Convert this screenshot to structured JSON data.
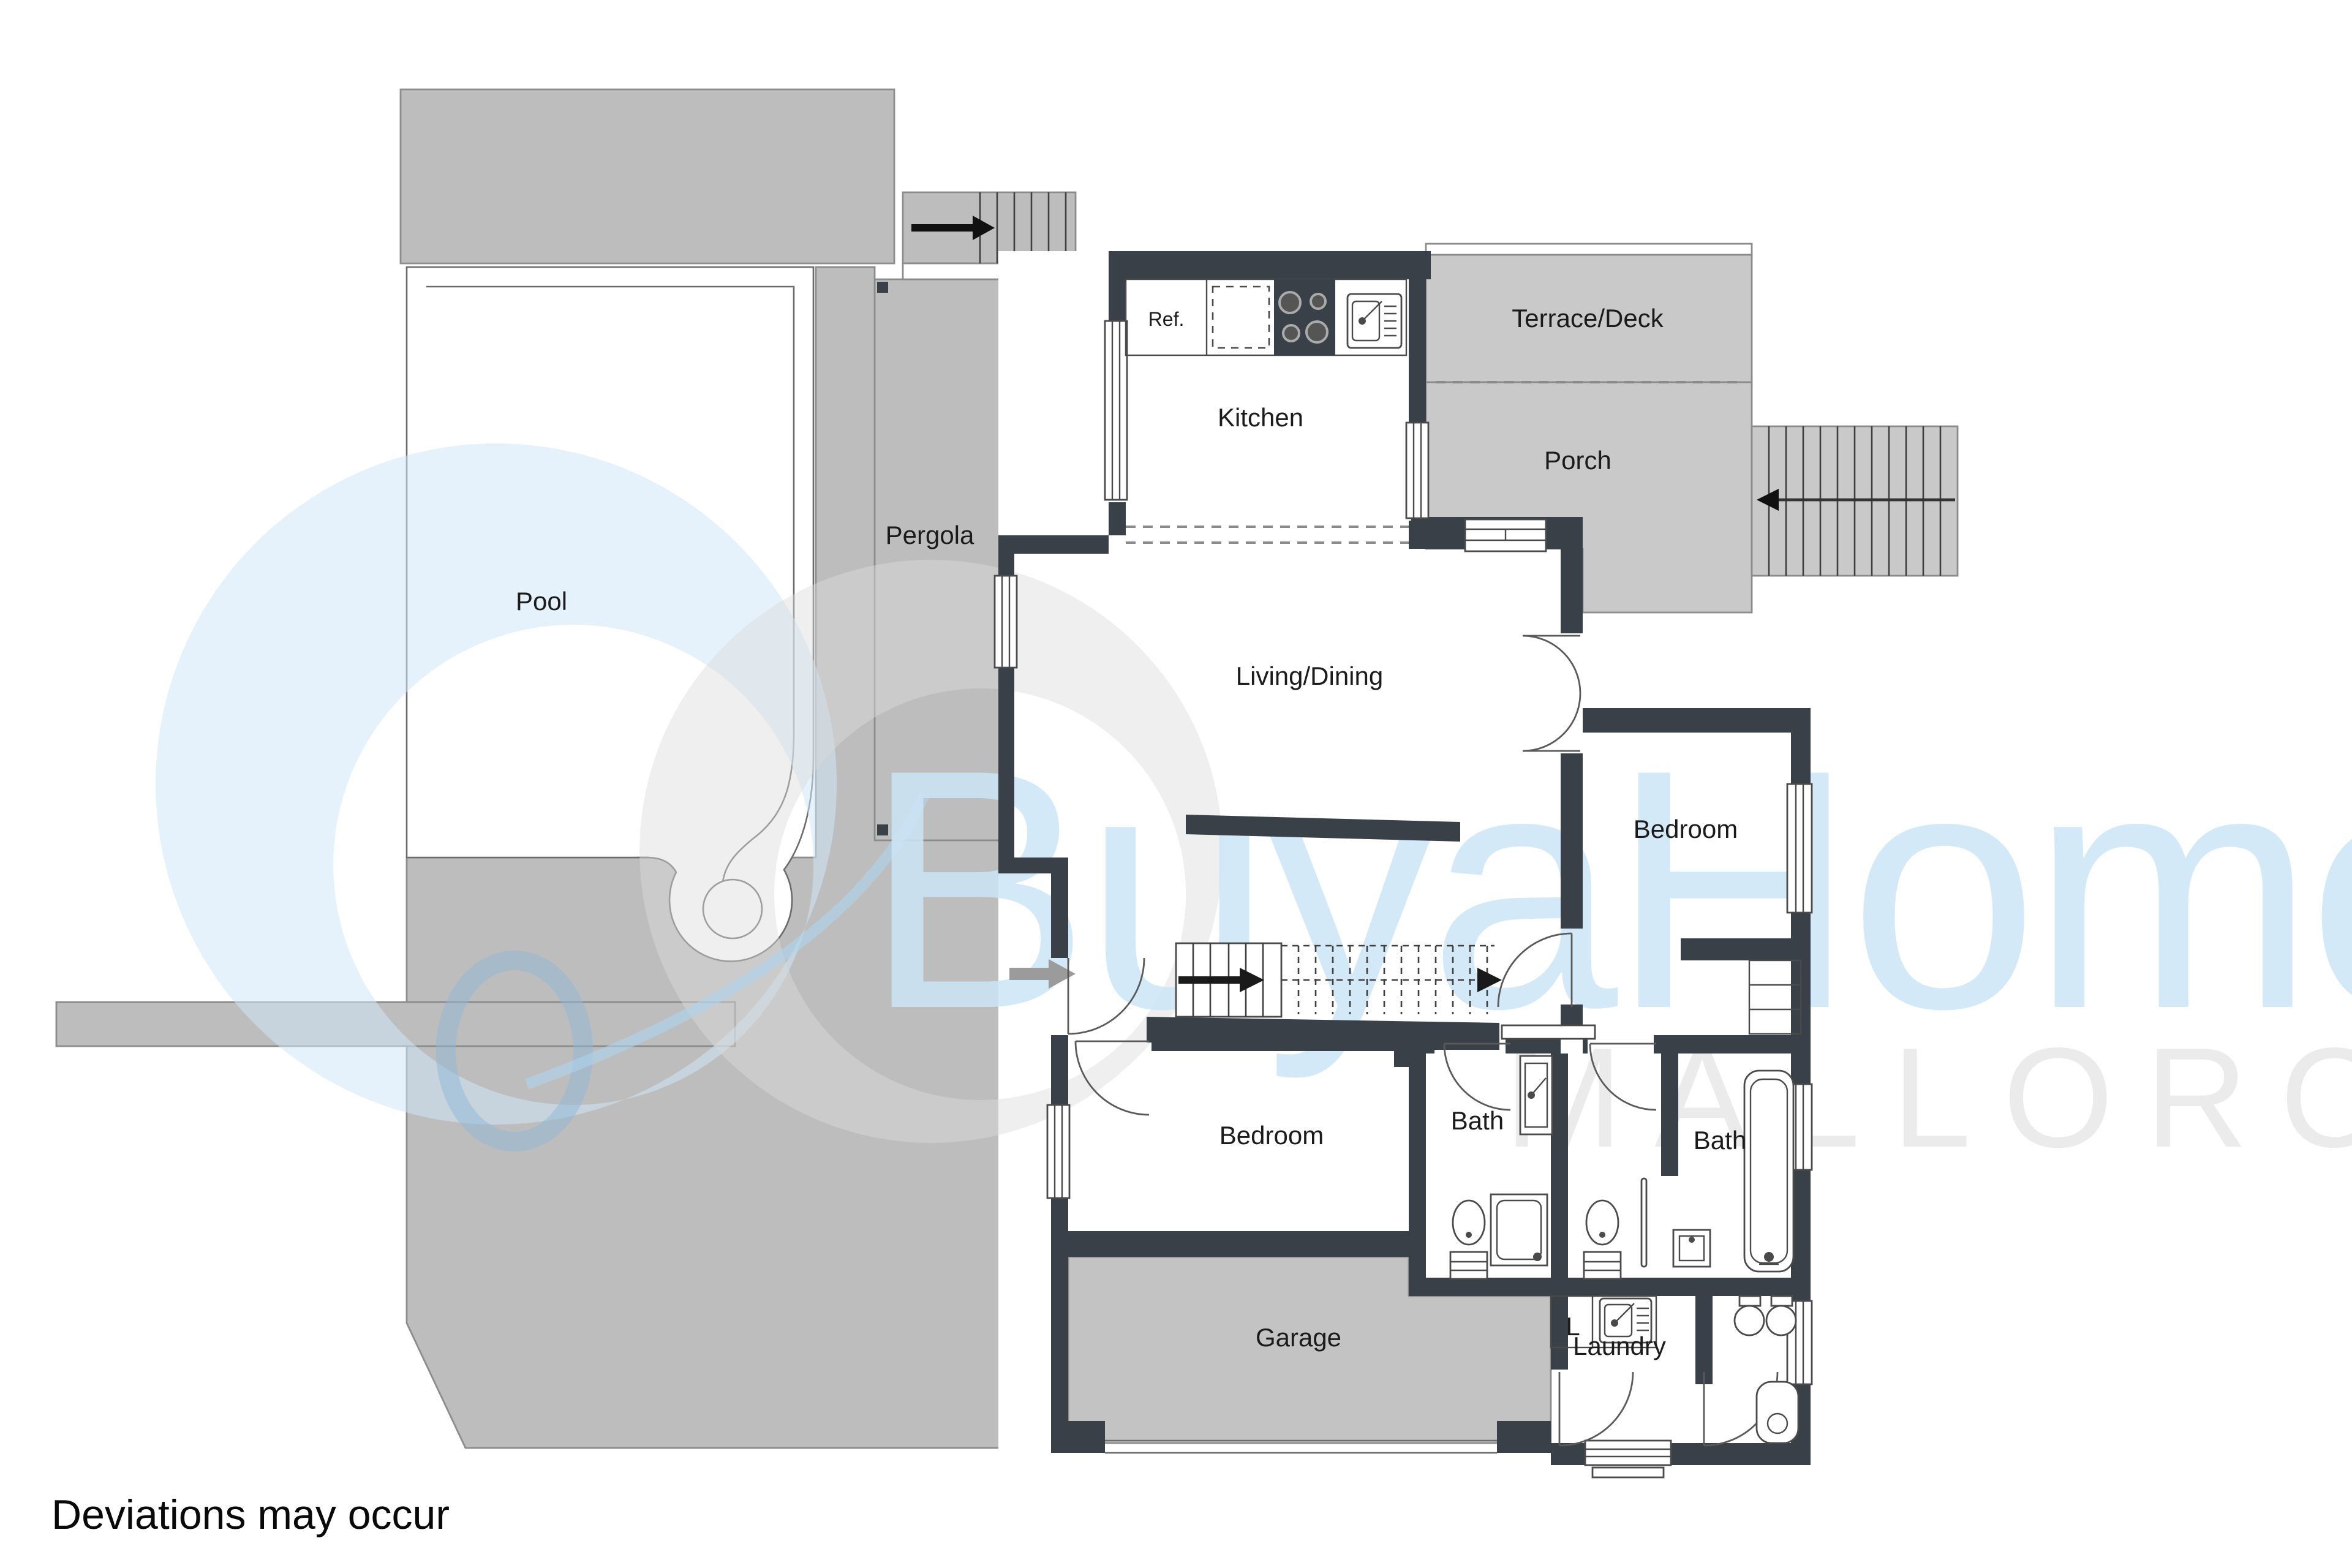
{
  "disclaimer": "Deviations may occur",
  "watermark": {
    "brand": "BuyaHome",
    "location": "MALLORCA",
    "brand_color": "#cde6f7",
    "location_color": "#e9e9e9",
    "logo_blue": "#cfe7f8",
    "logo_gray": "#dcdcdc",
    "logo_ring_blue": "#8fb8d8"
  },
  "rooms": {
    "pool": {
      "label": "Pool"
    },
    "pergola": {
      "label": "Pergola"
    },
    "kitchen": {
      "label": "Kitchen"
    },
    "fridge": {
      "label": "Ref."
    },
    "terrace": {
      "label": "Terrace/Deck"
    },
    "porch": {
      "label": "Porch"
    },
    "living": {
      "label": "Living/Dining"
    },
    "bedroom_right": {
      "label": "Bedroom"
    },
    "bedroom_left": {
      "label": "Bedroom"
    },
    "bath_left": {
      "label": "Bath"
    },
    "bath_right": {
      "label": "Bath"
    },
    "garage": {
      "label": "Garage"
    },
    "linen_closet": {
      "label": "L"
    },
    "laundry": {
      "label": "Laundry"
    }
  },
  "icons": [
    "stairs-up-arrow",
    "entry-arrow",
    "stove",
    "kitchen-sink",
    "laundry-sink",
    "toilet",
    "shower",
    "bathtub",
    "washer",
    "dryer",
    "water-heater",
    "window",
    "door-arc"
  ],
  "colors": {
    "wall": "#3a4047",
    "deck": "#bdbdbd",
    "terrace": "#c9c9c9",
    "garage": "#c3c3c3",
    "line": "#6b6b6b"
  }
}
